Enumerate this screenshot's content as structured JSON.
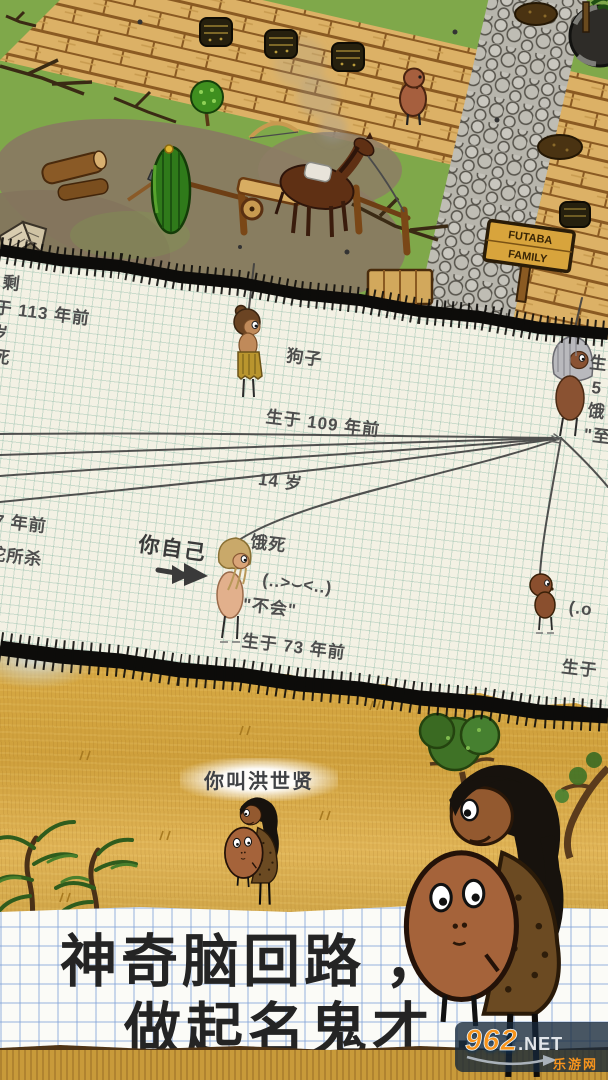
{
  "top_scene": {
    "sign_line1": "FUTABA",
    "sign_line2": "FAMILY"
  },
  "family_tree": {
    "left_top_fragments": [
      "剩",
      "于 113 年前",
      "岁",
      "死"
    ],
    "gouzi": {
      "name": "狗子",
      "born": "生于 109 年前",
      "age": "14 岁",
      "death": "饿死",
      "quote": "\"不会\""
    },
    "right_top_fragments": [
      "生",
      "5",
      "饿",
      "\"至"
    ],
    "left_mid_fragments": [
      "7 年前",
      "蛇所杀"
    ],
    "you_label": "你自己",
    "you": {
      "emoticon": "(..>⌣<..)",
      "born": "生于 73 年前",
      "age": "60 岁",
      "death": "死于年老",
      "quote": "\"吾命已休矣\""
    },
    "right_bottom_fragments": [
      "(.o",
      "生于",
      "5 岁",
      "被黄",
      "\"斧头"
    ]
  },
  "savanna": {
    "name_label": "你叫洪世贤"
  },
  "caption": {
    "line1": "神奇脑回路 ，",
    "line2": "做起名鬼才 ."
  },
  "watermark": {
    "number": "962",
    "suffix": ".NET",
    "site_name": "乐游网"
  },
  "colors": {
    "paper": "#f3f1e4",
    "paper_grid": "#cfe0d4",
    "notebook": "#fbfbf7",
    "notebook_grid": "#aac4e4",
    "ink": "#242424",
    "pencil": "#4d4d4d",
    "savanna": "#d8a843",
    "grass": "#7fa84a",
    "wood": "#dcb166",
    "stone": "#b7b5ac",
    "watermark_orange": "#f7941d"
  }
}
